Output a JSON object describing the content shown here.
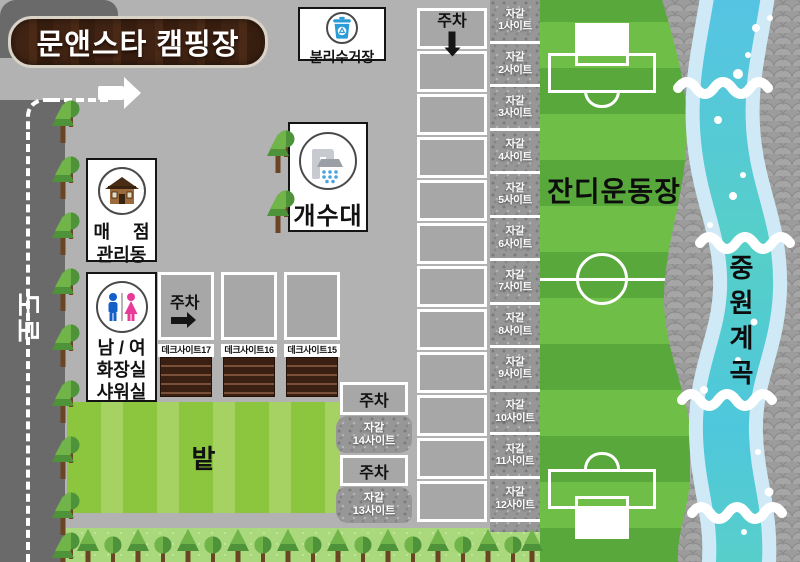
{
  "title": "문앤스타 캠핑장",
  "road": {
    "label": "도로"
  },
  "parking": {
    "label": "주차"
  },
  "facilities": {
    "recycling": {
      "label": "분리수거장",
      "icon": "recycle-bin-icon"
    },
    "sink": {
      "label": "개수대",
      "icon": "faucet-icon"
    },
    "store": {
      "line1": "매 점",
      "line2": "관리동",
      "icon": "house-icon"
    },
    "restroom": {
      "label": "남 / 여\n화장실\n샤워실",
      "icons": [
        "male-icon",
        "female-icon"
      ]
    }
  },
  "deck_sites": [
    {
      "label": "데크사이트17"
    },
    {
      "label": "데크사이트16"
    },
    {
      "label": "데크사이트15"
    }
  ],
  "gravel_sites": [
    {
      "label": "자갈\n1사이트"
    },
    {
      "label": "자갈\n2사이트"
    },
    {
      "label": "자갈\n3사이트"
    },
    {
      "label": "자갈\n4사이트"
    },
    {
      "label": "자갈\n5사이트"
    },
    {
      "label": "자갈\n6사이트"
    },
    {
      "label": "자갈\n7사이트"
    },
    {
      "label": "자갈\n8사이트"
    },
    {
      "label": "자갈\n9사이트"
    },
    {
      "label": "자갈\n10사이트"
    },
    {
      "label": "자갈\n11사이트"
    },
    {
      "label": "자갈\n12사이트"
    }
  ],
  "extra_gravel_sites": [
    {
      "label": "자갈\n14사이트"
    },
    {
      "label": "자갈\n13사이트"
    }
  ],
  "areas": {
    "field": {
      "label": "밭"
    },
    "sports_ground": {
      "label": "잔디운동장"
    },
    "valley": {
      "label": "중원계곡"
    }
  },
  "colors": {
    "sign_wood_brown": "#402313",
    "road_gray": "#6a6a6a",
    "field_green": "#8cc63e",
    "pitch_green_dark": "#58a83c",
    "pitch_green_light": "#6fbe48",
    "river_blue": "#55c3e6",
    "river_teal": "#56cfc8",
    "deck_brown": "#3a2012",
    "bin_blue": "#2b9cd8",
    "male_blue": "#1460c8",
    "female_pink": "#e83a96"
  }
}
